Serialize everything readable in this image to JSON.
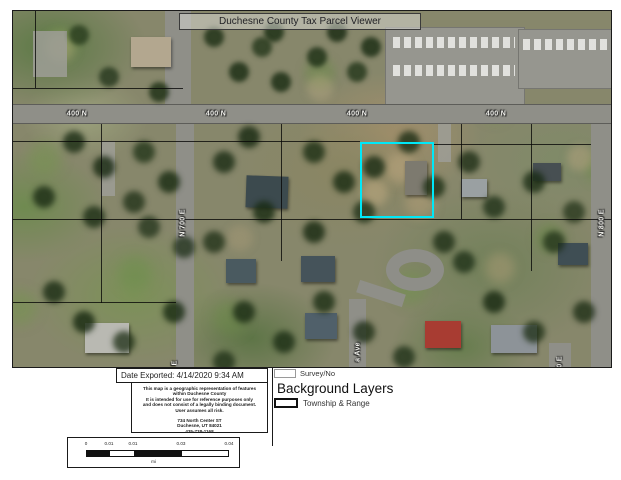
{
  "title_bar": {
    "title": "Duchesne County Tax Parcel Viewer"
  },
  "map": {
    "street_label_400n": "400 N",
    "road_label_n700e": "N 700 E",
    "road_label_n800e": "N 800 E",
    "road_label_ave_partial": "a Ave",
    "road_label_e_partial": "E",
    "road_label_0e_partial": "0 E",
    "highlight_color": "#00e8f8"
  },
  "export_box": {
    "text": "Date Exported: 4/14/2020 9:34 AM"
  },
  "disclaimer_box": {
    "lines": [
      "This map is a geographic representation of features",
      "within Duchesne County",
      "It is intended for use for reference purposes only",
      "and does not consist of a legally binding document.",
      "User assumes all risk."
    ],
    "address_lines": [
      "734 North Center ST",
      "Duchesne, UT 84021",
      "435-738-1168"
    ]
  },
  "scale_bar": {
    "tick_labels": [
      "0",
      "0.01",
      "0.01",
      "0.03",
      "0.04"
    ],
    "unit": "mi"
  },
  "legend": {
    "survey_label": "Survey/No",
    "section_title": "Background Layers",
    "township_label": "Township & Range"
  }
}
